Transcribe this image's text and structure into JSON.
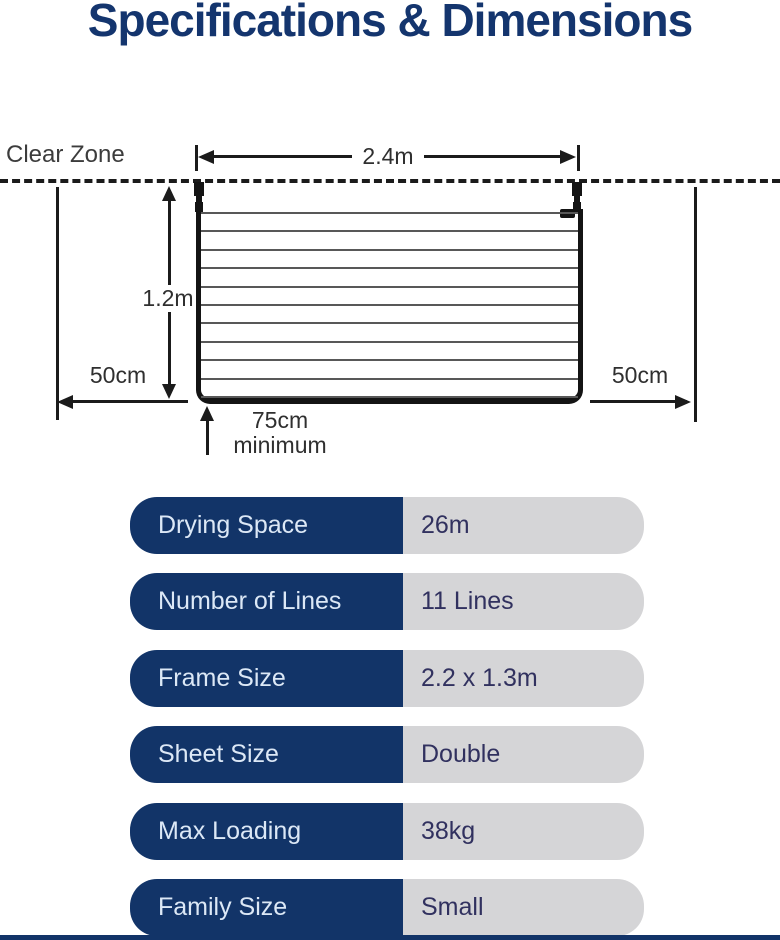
{
  "title": "Specifications & Dimensions",
  "colors": {
    "title_navy": "#14356e",
    "table_navy": "#123468",
    "table_gray": "#d5d5d7",
    "value_text": "#31315f",
    "diagram_line": "#1b1b1b"
  },
  "diagram": {
    "clear_zone_label": "Clear Zone",
    "width_label": "2.4m",
    "height_label": "1.2m",
    "left_clearance_label": "50cm",
    "right_clearance_label": "50cm",
    "floor_clearance_label": "75cm",
    "floor_clearance_sublabel": "minimum",
    "num_drying_lines": 11
  },
  "spec_table": {
    "rows": [
      {
        "label": "Drying Space",
        "value": "26m"
      },
      {
        "label": "Number of Lines",
        "value": "11 Lines"
      },
      {
        "label": "Frame Size",
        "value": "2.2 x 1.3m"
      },
      {
        "label": "Sheet Size",
        "value": "Double"
      },
      {
        "label": "Max Loading",
        "value": "38kg"
      },
      {
        "label": "Family Size",
        "value": "Small"
      }
    ]
  }
}
